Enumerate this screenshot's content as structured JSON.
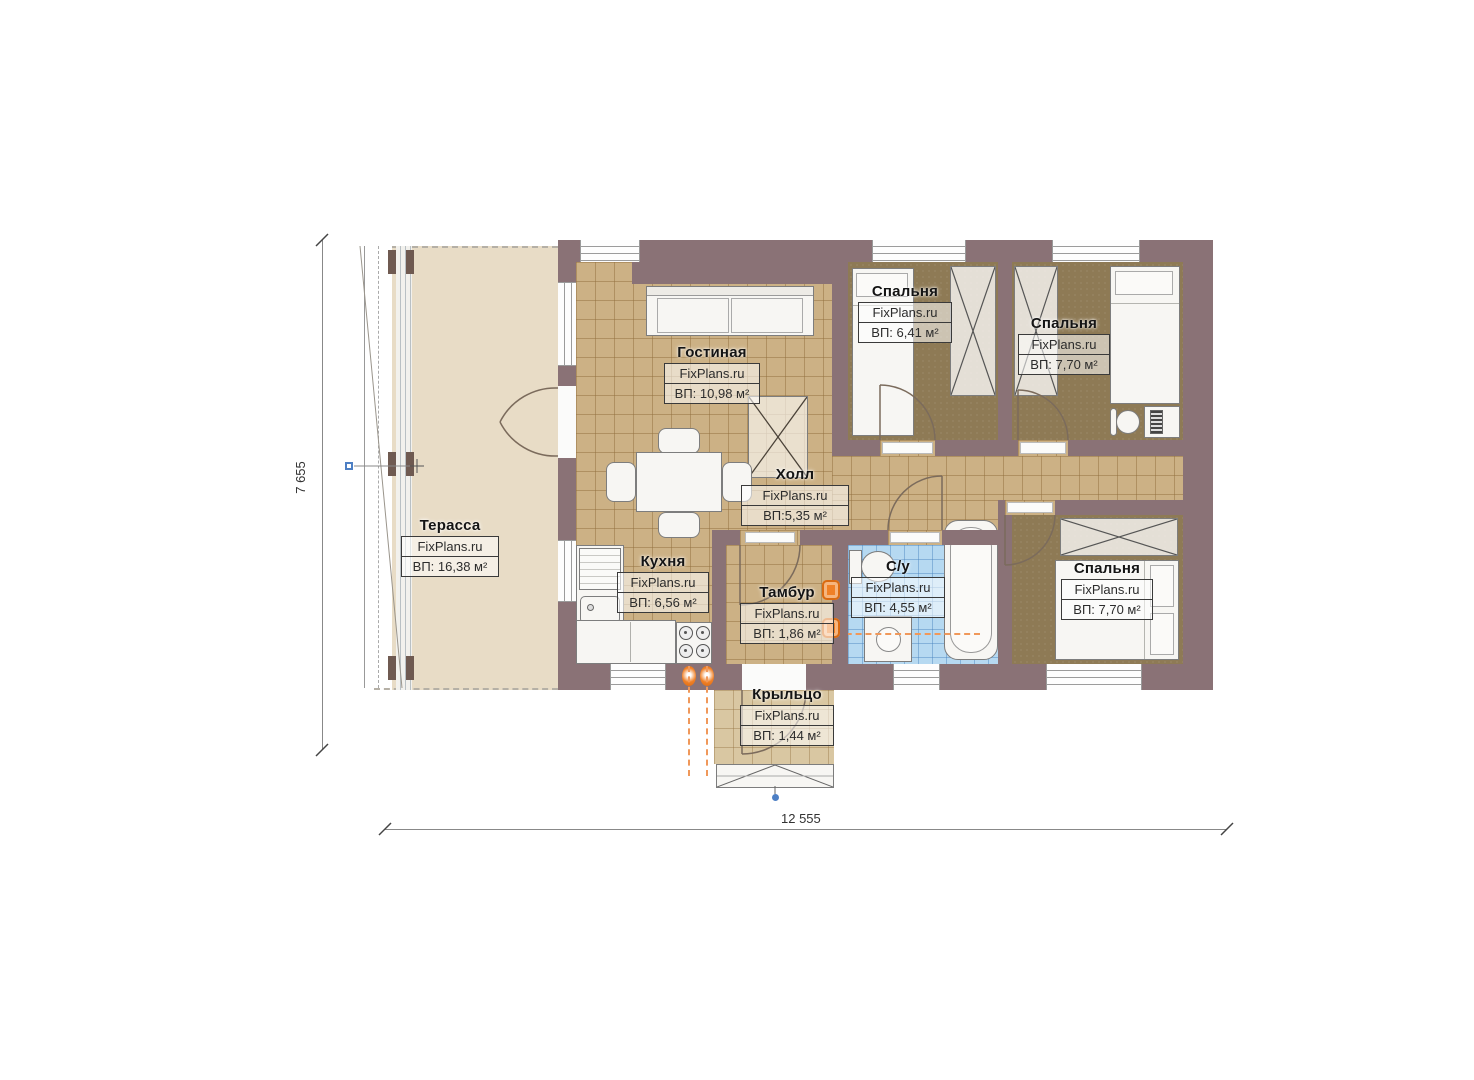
{
  "watermark": "FixPlans.ru",
  "dimensions": {
    "height_label": "7 655",
    "width_label": "12 555"
  },
  "rooms": {
    "terrace": {
      "name": "Терасса",
      "area": "ВП: 16,38 м²"
    },
    "living": {
      "name": "Гостиная",
      "area": "ВП: 10,98 м²"
    },
    "bedroom1": {
      "name": "Спальня",
      "area": "ВП: 6,41 м²"
    },
    "bedroom2": {
      "name": "Спальня",
      "area": "ВП: 7,70 м²"
    },
    "hall": {
      "name": "Холл",
      "area": "ВП:5,35 м²"
    },
    "kitchen": {
      "name": "Кухня",
      "area": "ВП: 6,56 м²"
    },
    "tambour": {
      "name": "Тамбур",
      "area": "ВП: 1,86 м²"
    },
    "bathroom": {
      "name": "С/у",
      "area": "ВП: 4,55 м²"
    },
    "bedroom3": {
      "name": "Спальня",
      "area": "ВП: 7,70 м²"
    },
    "porch": {
      "name": "Крыльцо",
      "area": "ВП: 1,44 м²"
    }
  }
}
